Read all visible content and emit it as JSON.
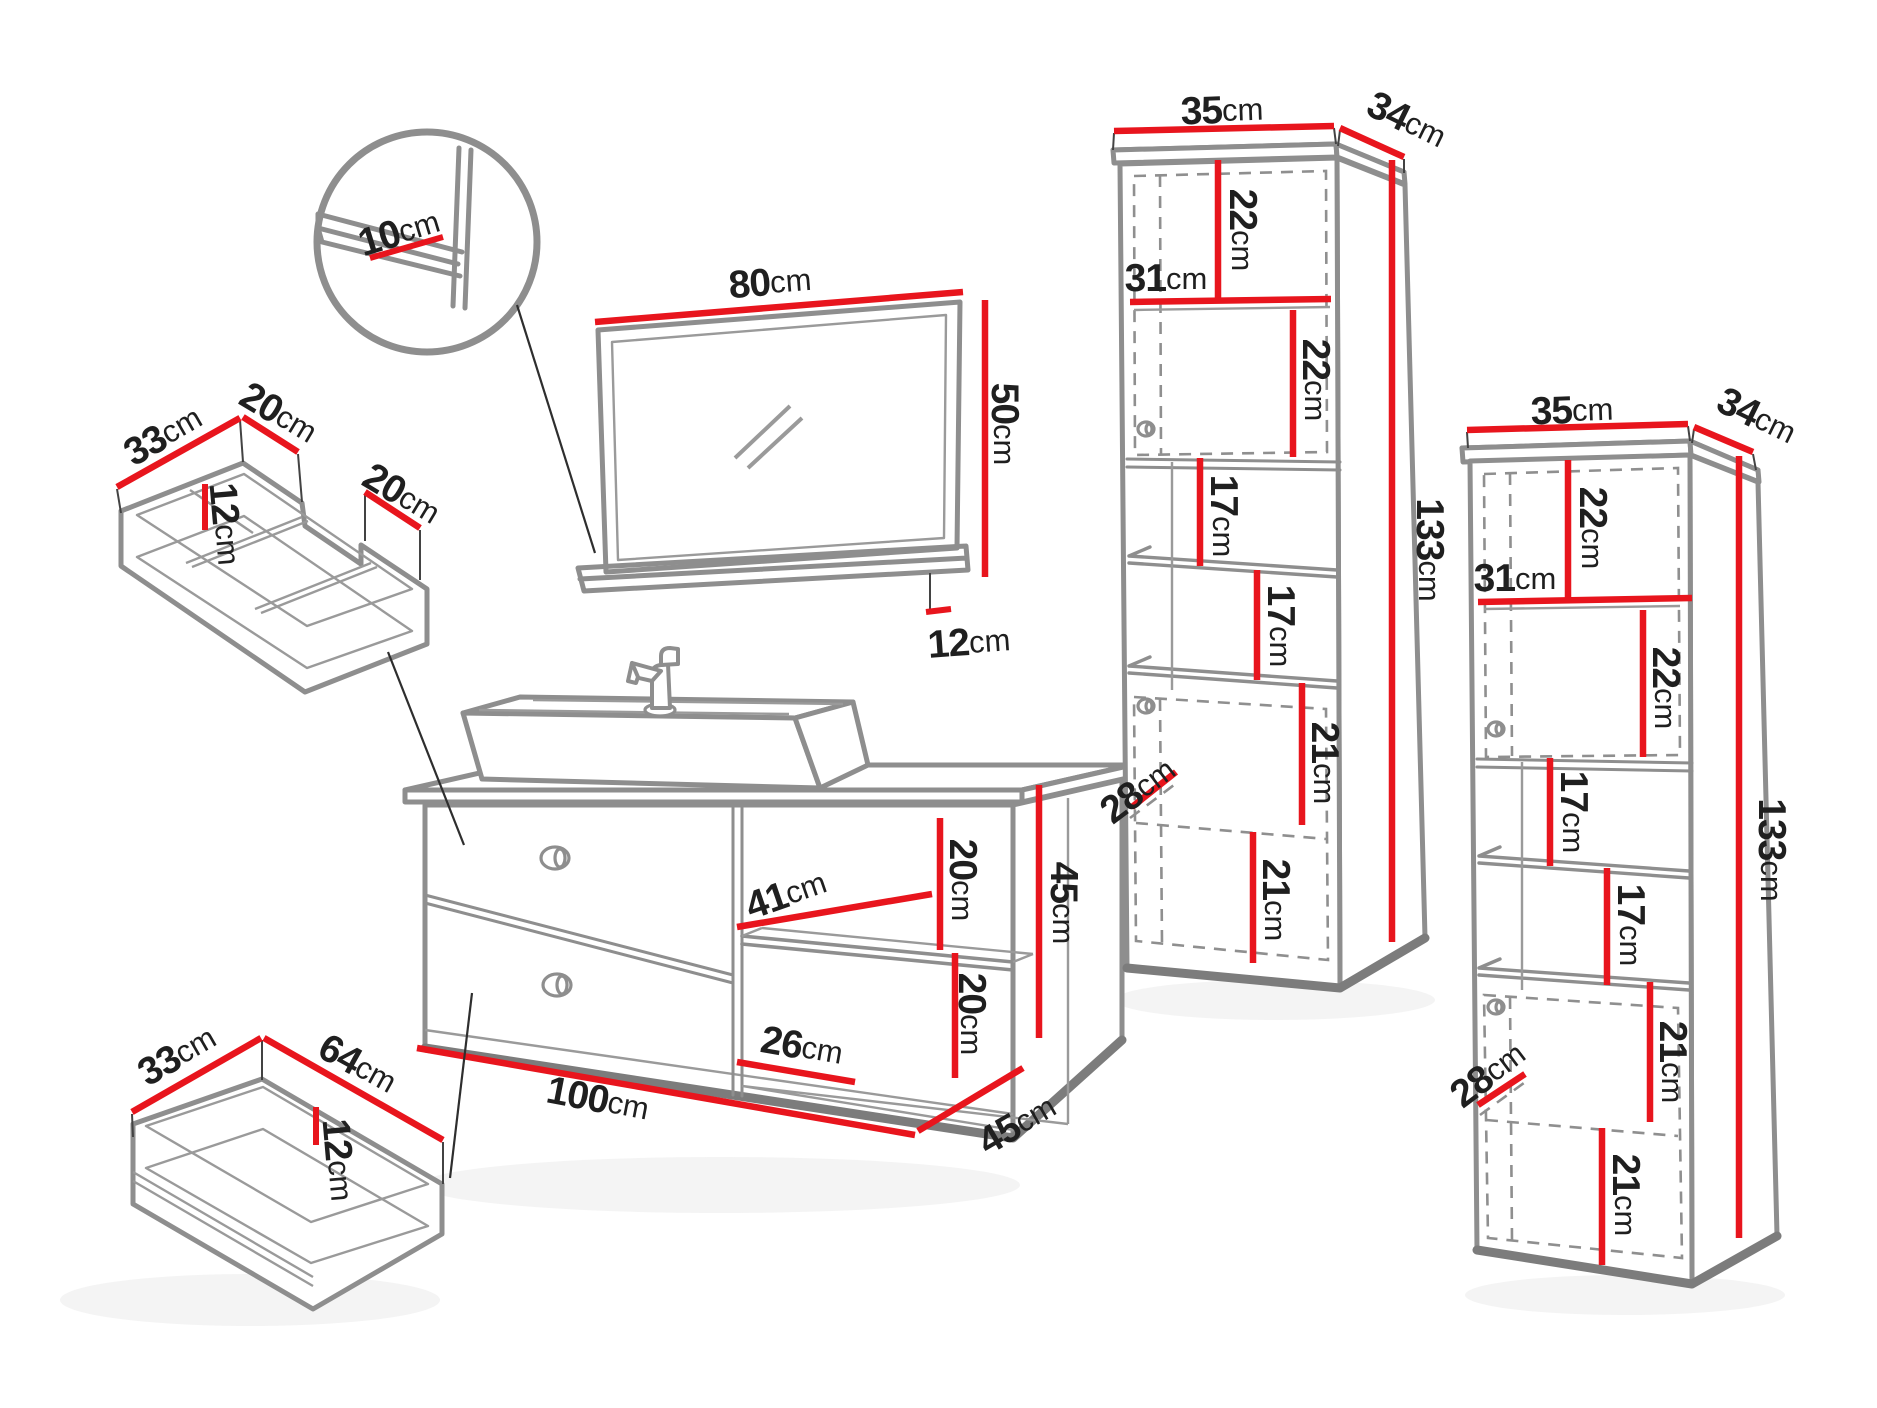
{
  "page": {
    "background": "#ffffff"
  },
  "colors": {
    "dimension_red": "#e8151d",
    "artwork_gray": "#8e8e8e",
    "text": "#1f1f1f"
  },
  "furniture": {
    "detail_circle": {
      "shelf_depth": {
        "num": "10",
        "unit": "cm"
      }
    },
    "mirror": {
      "width": {
        "num": "80",
        "unit": "cm"
      },
      "height": {
        "num": "50",
        "unit": "cm"
      },
      "shelf_offset": {
        "num": "12",
        "unit": "cm"
      }
    },
    "drawer_organizer": {
      "depth": {
        "num": "33",
        "unit": "cm"
      },
      "left_section_width": {
        "num": "20",
        "unit": "cm"
      },
      "divider_height": {
        "num": "12",
        "unit": "cm"
      },
      "right_section_width": {
        "num": "20",
        "unit": "cm"
      }
    },
    "vanity": {
      "niche_top_height": {
        "num": "20",
        "unit": "cm"
      },
      "shelf_depth": {
        "num": "41",
        "unit": "cm"
      },
      "niche_bottom_height": {
        "num": "20",
        "unit": "cm"
      },
      "niche_width": {
        "num": "26",
        "unit": "cm"
      },
      "width": {
        "num": "100",
        "unit": "cm"
      },
      "height": {
        "num": "45",
        "unit": "cm"
      },
      "depth": {
        "num": "45",
        "unit": "cm"
      }
    },
    "drawer": {
      "depth": {
        "num": "33",
        "unit": "cm"
      },
      "width": {
        "num": "64",
        "unit": "cm"
      },
      "height": {
        "num": "12",
        "unit": "cm"
      }
    },
    "cabinet_left": {
      "width": {
        "num": "35",
        "unit": "cm"
      },
      "depth": {
        "num": "34",
        "unit": "cm"
      },
      "top_compartment": {
        "num": "22",
        "unit": "cm"
      },
      "interior_width": {
        "num": "31",
        "unit": "cm"
      },
      "second_compartment": {
        "num": "22",
        "unit": "cm"
      },
      "shelf_gap_1": {
        "num": "17",
        "unit": "cm"
      },
      "shelf_gap_2": {
        "num": "17",
        "unit": "cm"
      },
      "lower_compartment_1": {
        "num": "21",
        "unit": "cm"
      },
      "door_width": {
        "num": "28",
        "unit": "cm"
      },
      "lower_compartment_2": {
        "num": "21",
        "unit": "cm"
      },
      "height": {
        "num": "133",
        "unit": "cm"
      }
    },
    "cabinet_right": {
      "width": {
        "num": "35",
        "unit": "cm"
      },
      "depth": {
        "num": "34",
        "unit": "cm"
      },
      "top_compartment": {
        "num": "22",
        "unit": "cm"
      },
      "interior_width": {
        "num": "31",
        "unit": "cm"
      },
      "second_compartment": {
        "num": "22",
        "unit": "cm"
      },
      "shelf_gap_1": {
        "num": "17",
        "unit": "cm"
      },
      "shelf_gap_2": {
        "num": "17",
        "unit": "cm"
      },
      "lower_compartment_1": {
        "num": "21",
        "unit": "cm"
      },
      "door_width": {
        "num": "28",
        "unit": "cm"
      },
      "lower_compartment_2": {
        "num": "21",
        "unit": "cm"
      },
      "height": {
        "num": "133",
        "unit": "cm"
      }
    }
  }
}
